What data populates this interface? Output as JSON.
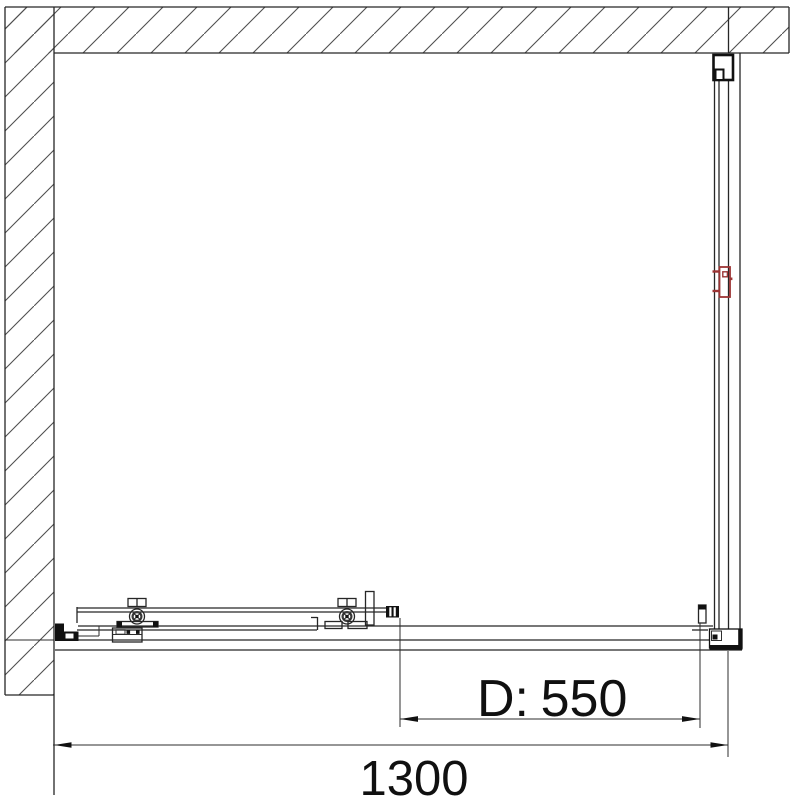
{
  "dimensions": {
    "door_opening": {
      "label": "D:",
      "value": "550"
    },
    "total_width": {
      "value": "1300"
    }
  },
  "colors": {
    "line": "#262626",
    "accent_red": "#9c3434",
    "hatch": "#4f4f4f",
    "background": "#ffffff"
  }
}
